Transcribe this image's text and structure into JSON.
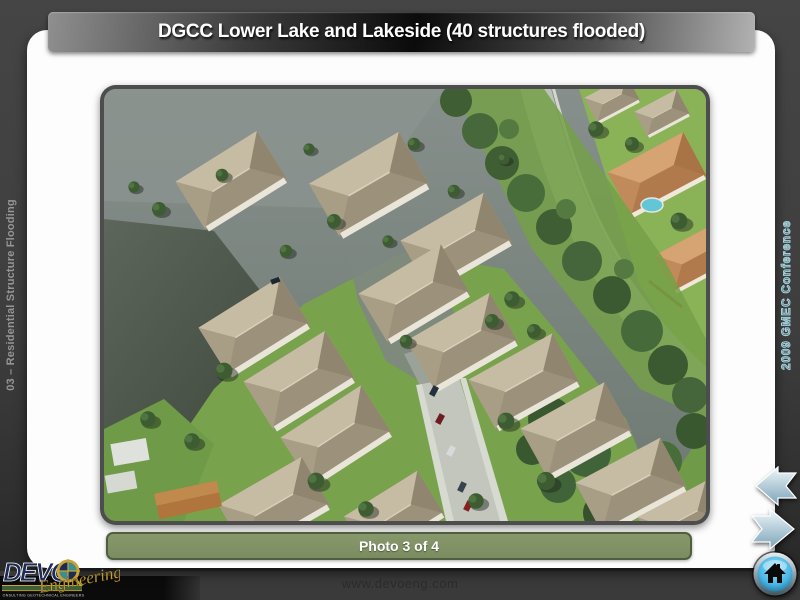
{
  "slide": {
    "title": "DGCC Lower Lake and Lakeside (40 structures flooded)",
    "left_rail_label": "03 – Residential Structure Flooding",
    "right_rail_label": "2009 GMEC Conference",
    "caption": "Photo 3 of 4",
    "footer_url": "www.devoeng.com"
  },
  "photo": {
    "description": "Aerial photograph of a flooded residential neighborhood: rows of tan hip-roofed houses standing in flood water, a dark lake at lower left, a partially flooded street with parked cars at lower right, a diagonal tree-lined buffer with a road, and unflooded homes with terracotta roofs and a pool at upper right."
  },
  "logo": {
    "name": "DEVO",
    "script": "Engineering",
    "tagline": "CONSULTING  GEOTECHNICAL  ENGINEERS"
  },
  "nav": {
    "back_icon": "arrow-left-icon",
    "forward_icon": "arrow-right-icon",
    "home_icon": "home-icon"
  },
  "colors": {
    "background": "#3e3e3e",
    "banner_dark": "#0b0b0b",
    "caption_fill": "#7a8c60",
    "caption_border": "#4e5e3f",
    "rail_text": "#959595",
    "rail_outline_text": "#a4d3dd",
    "arrow_blue": "#9fc3d4",
    "home_button_blue": "#49b6e3",
    "logo_navy": "#1e2c55",
    "logo_gold": "#c9a43c",
    "water": "#7e8984",
    "lake_dark": "#39443a",
    "roof_tan": "#b2a78f",
    "roof_terracotta": "#c68f60",
    "grass": "#79a24d"
  }
}
